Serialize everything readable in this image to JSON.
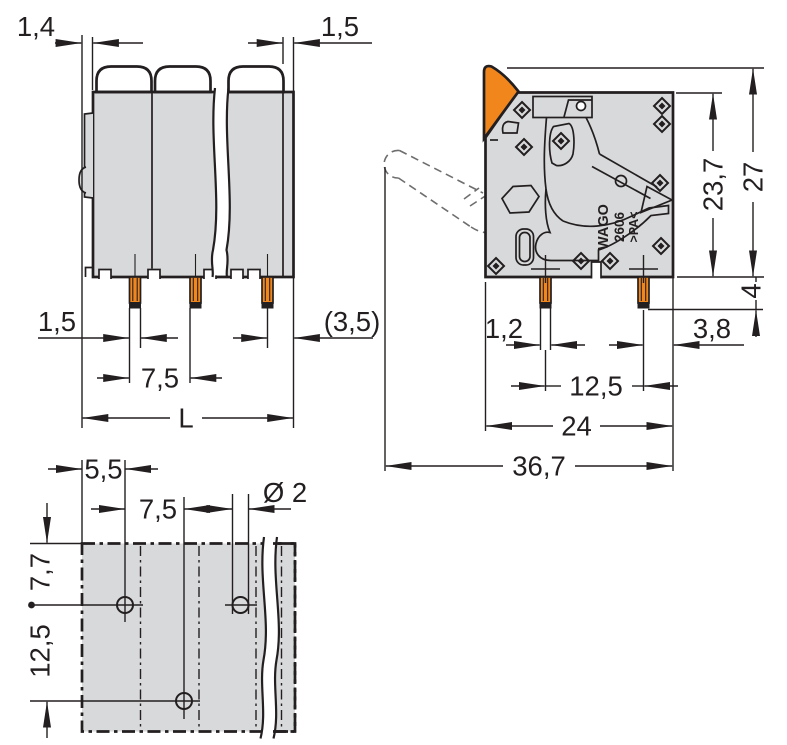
{
  "front_view": {
    "dim_housing_wall_left": "1,4",
    "dim_housing_wall_right": "1,5",
    "dim_pin_width": "1,5",
    "dim_pole_pitch": "7,5",
    "dim_end_distance": "(3,5)",
    "dim_total_length": "L"
  },
  "side_view": {
    "dim_clamp_height": "23,7",
    "dim_total_height": "27",
    "dim_pin_protrusion": "4",
    "dim_pin_width": "1,2",
    "dim_pin_to_edge": "3,8",
    "dim_pin_row_spacing": "12,5",
    "dim_housing_depth": "24",
    "dim_total_depth": "36,7",
    "marking": {
      "brand": "WAGO",
      "series": "2606",
      "material": ">PA<"
    }
  },
  "drill_view": {
    "dim_edge_to_first_hole": "5,5",
    "dim_hole_pitch": "7,5",
    "dim_hole_diameter": "Ø 2",
    "dim_top_row_offset": "7,7",
    "dim_row_spacing": "12,5"
  },
  "colors": {
    "accent_orange": "#F0861C",
    "housing_gray": "#D8D9DA",
    "line_dark": "#231F20",
    "dashed_gray": "#6E6E6E"
  }
}
